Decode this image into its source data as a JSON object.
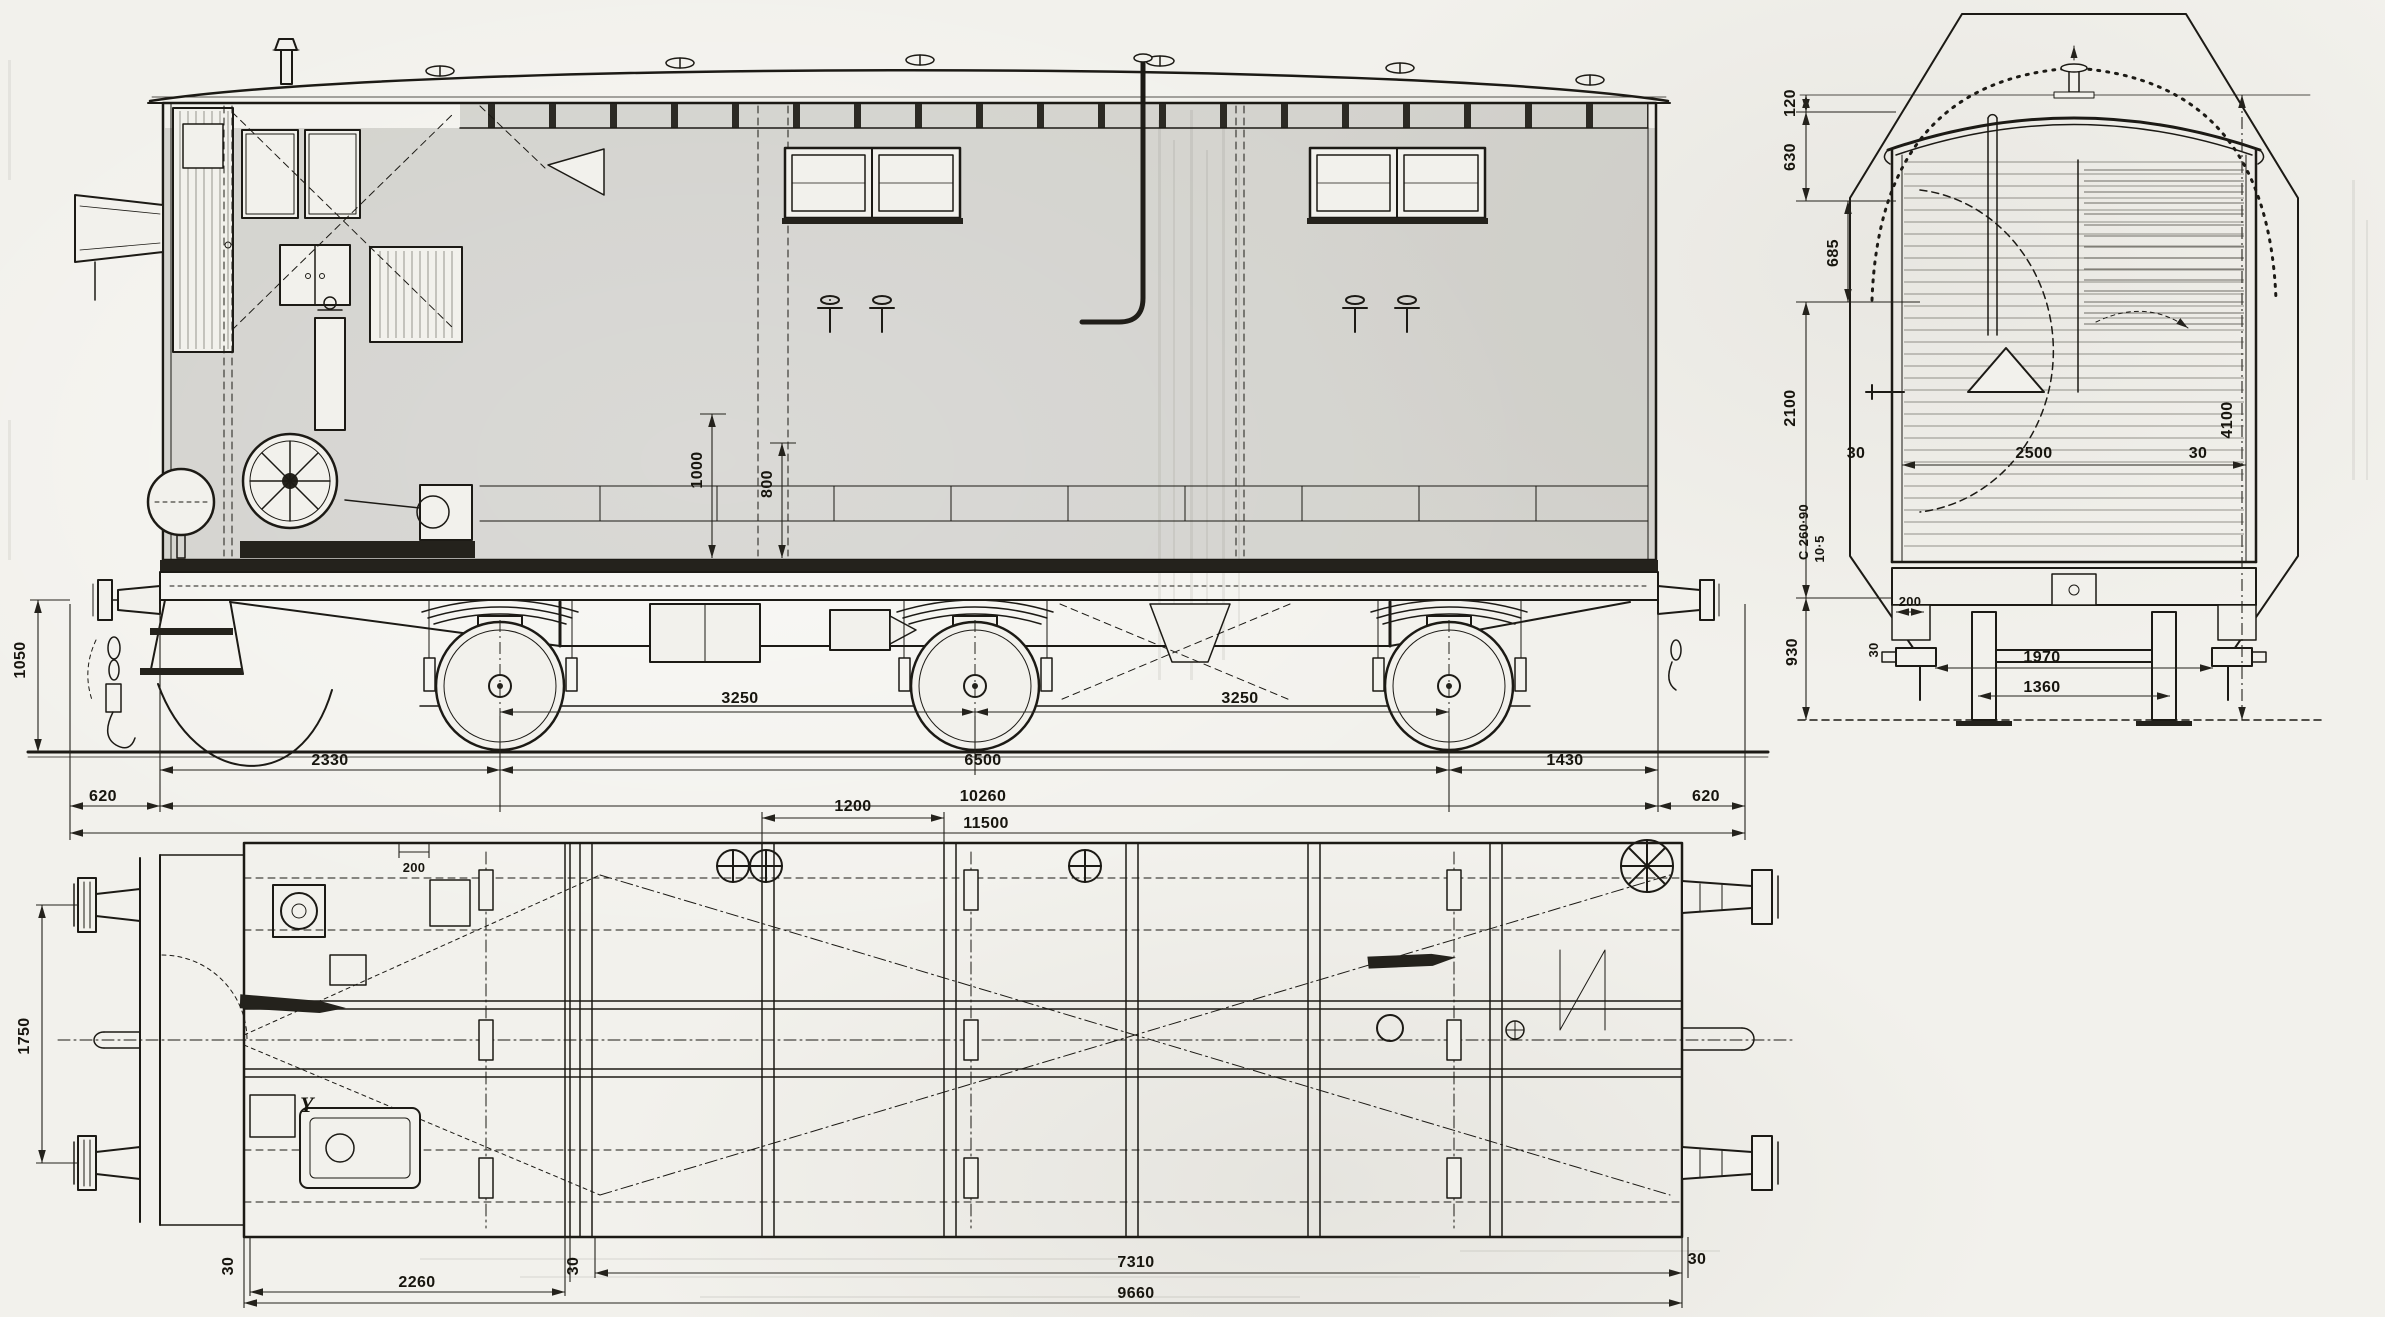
{
  "side": {
    "buffer_height": "1050",
    "wall_h1": "1000",
    "wall_h2": "800",
    "axle_span_1": "3250",
    "axle_span_2": "3250",
    "end_to_axle": "2330",
    "axle_base_total": "6500",
    "axle_to_end": "1430",
    "buffer_left": "620",
    "body_length": "10260",
    "buffer_right": "620",
    "length_over_buffers": "11500"
  },
  "section": {
    "roof_rise": "120",
    "roof_height": "630",
    "cant_height": "685",
    "wall_height": "2100",
    "frame_profile": "C 260·90",
    "frame_web": "10·5",
    "frame_to_rail": "930",
    "wall_thk_left": "30",
    "interior_width": "2500",
    "wall_thk_right": "30",
    "overall_height": "4100",
    "journal_width": "200",
    "journal_plate": "30",
    "journal_centers": "1970",
    "wheel_back_to_back": "1360"
  },
  "plan": {
    "panel_width": "1200",
    "buffer_centers": "1750",
    "hatch_width": "200",
    "wall_thk_a": "30",
    "end_bay_length": "2260",
    "wall_thk_b": "30",
    "main_bay_length": "7310",
    "frame_length": "9660",
    "wall_thk_c": "30",
    "section_marker": "Y"
  }
}
